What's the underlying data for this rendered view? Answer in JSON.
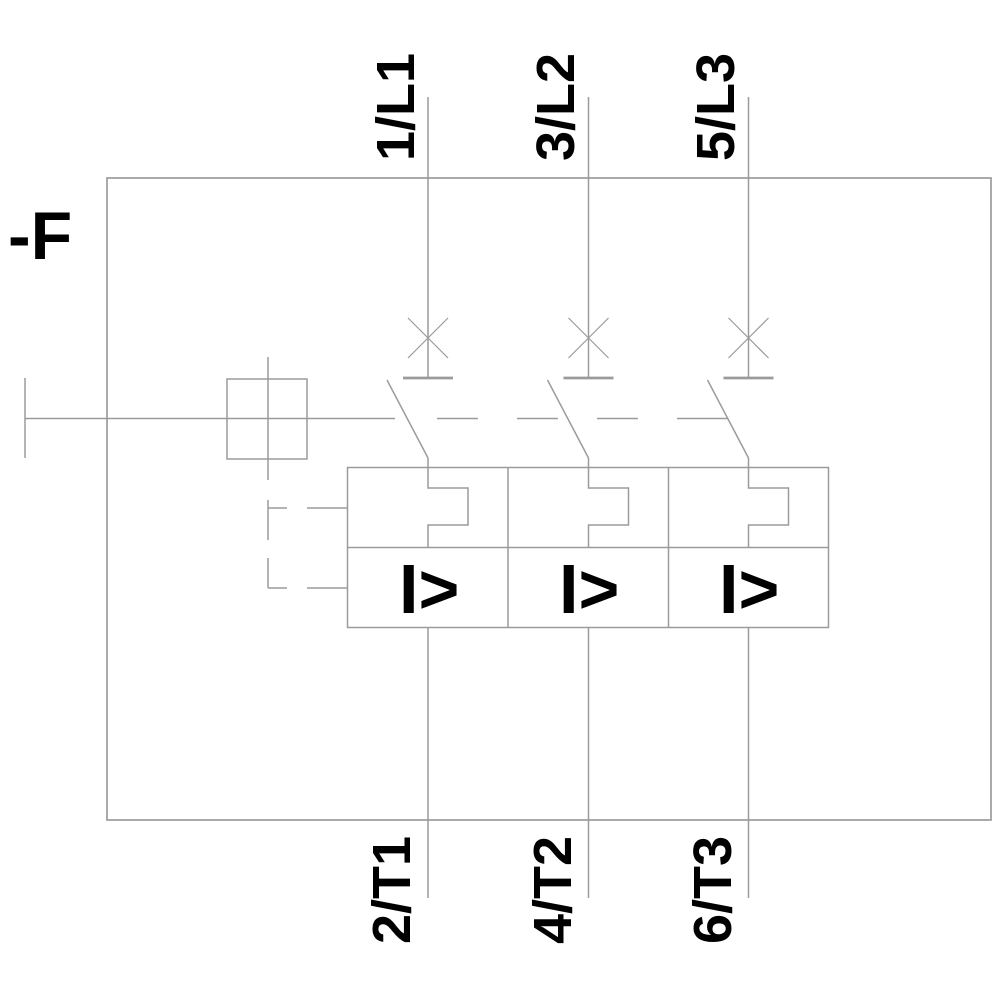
{
  "diagram": {
    "device_label": "-F",
    "top_terminals": [
      {
        "label": "1/L1"
      },
      {
        "label": "3/L2"
      },
      {
        "label": "5/L3"
      }
    ],
    "bottom_terminals": [
      {
        "label": "2/T1"
      },
      {
        "label": "4/T2"
      },
      {
        "label": "6/T3"
      }
    ],
    "trip_units": {
      "overcurrent_symbol": "I>"
    },
    "colors": {
      "line": "#9b9b9b",
      "text": "#000000",
      "background": "#ffffff"
    }
  }
}
